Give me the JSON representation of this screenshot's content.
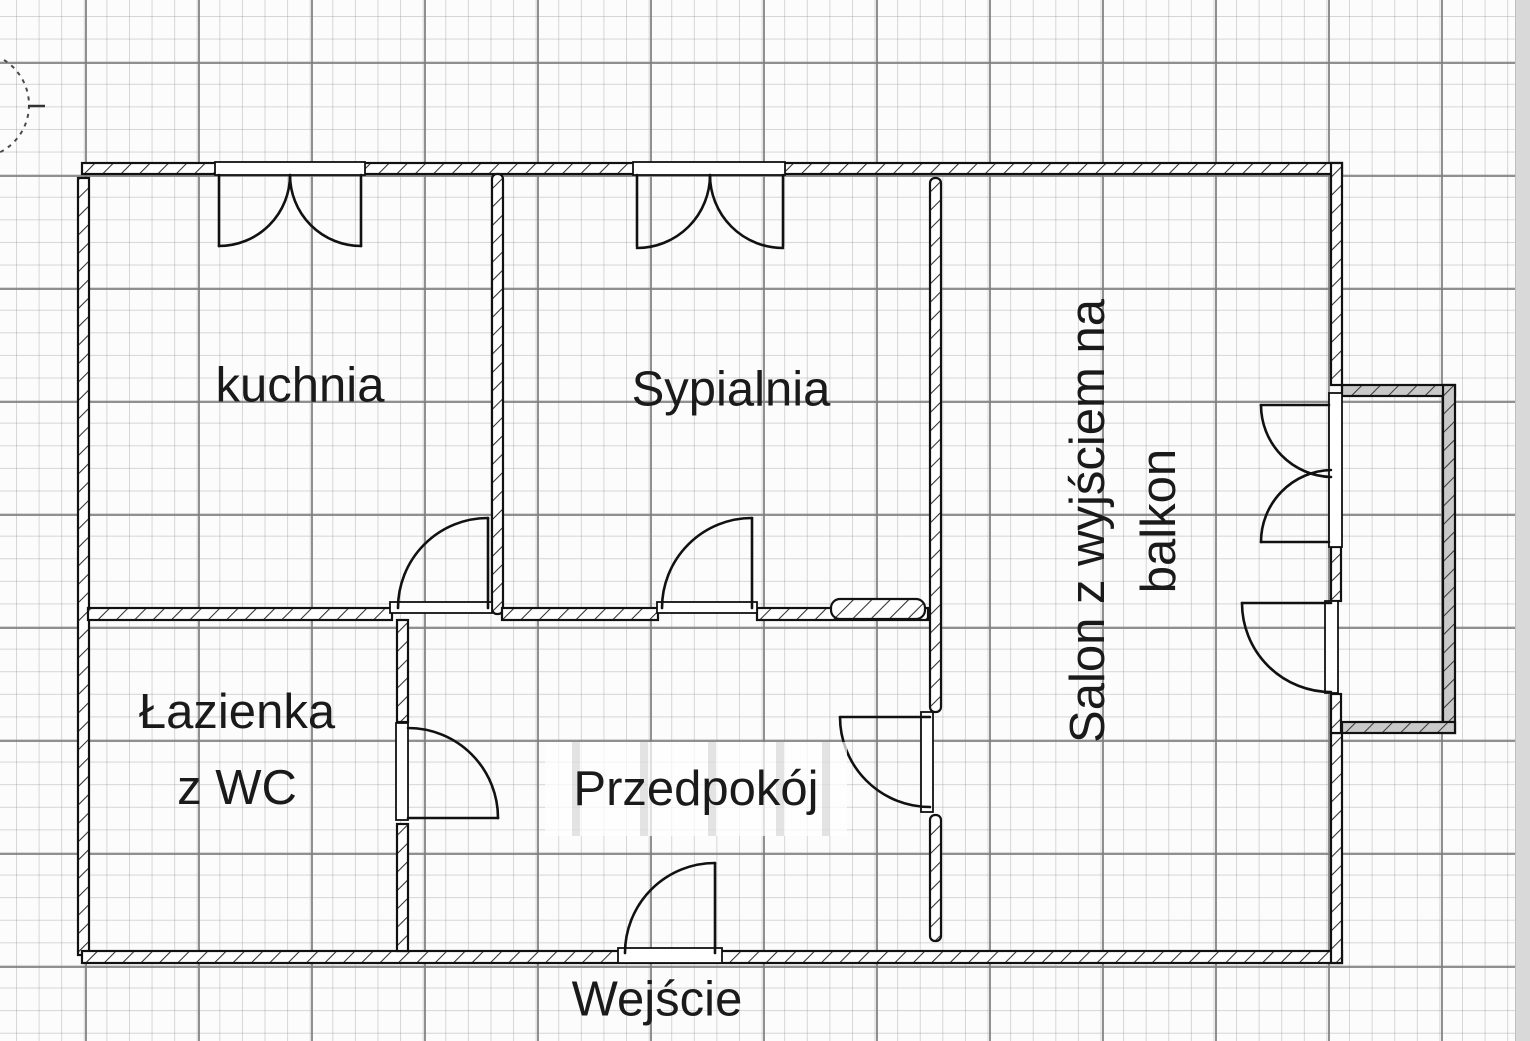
{
  "drawing": {
    "kind": "apartment floor plan on graph paper",
    "colors": {
      "wall_outline": "#111111",
      "wall_hatch": "#2e2e2e",
      "balcony_wall_fill": "#c9c9c9",
      "grid_minor": "#c6c6c6",
      "grid_major": "#8a8a8a",
      "paper": "#fcfcfc",
      "text": "#1a1a1a",
      "page_edge_strip": "#d9d9d9"
    }
  },
  "rooms": {
    "kitchen": {
      "label": "kuchnia"
    },
    "bedroom": {
      "label": "Sypialnia"
    },
    "bathroom": {
      "line1": "Łazienka",
      "line2": "z WC"
    },
    "hallway": {
      "label": "Przedpokój"
    },
    "living_room": {
      "line1": "Salon z wyjściem na",
      "line2": "balkon"
    },
    "entrance": {
      "label": "Wejście"
    }
  }
}
